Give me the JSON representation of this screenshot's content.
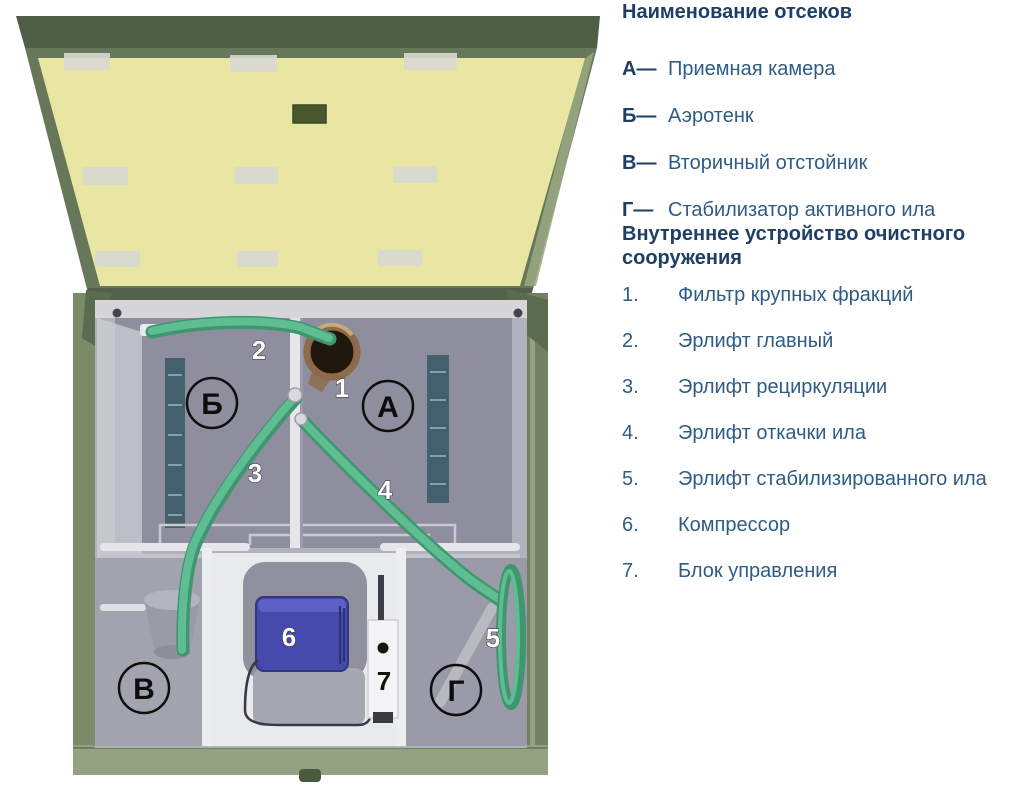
{
  "colors": {
    "lid_frame_green": "#51614a",
    "lid_underside_yellow": "#e9e5a3",
    "shell_green": "#7b8a67",
    "bottom_rim_green": "#93a282",
    "interior_gray": "#8e8e9f",
    "tube_green": "#52ad83",
    "inlet_brown": "#8d6b4a",
    "compressor_blue": "#474aad",
    "heading_text_blue": "#1e3e66",
    "body_text_blue": "#2e5c85"
  },
  "diagram": {
    "compartments": [
      {
        "letter": "Б"
      },
      {
        "letter": "А"
      },
      {
        "letter": "В"
      },
      {
        "letter": "Г"
      }
    ],
    "numbers": [
      "1",
      "2",
      "3",
      "4",
      "5",
      "6",
      "7"
    ]
  },
  "legend": {
    "compartments_heading": "Наименование отсеков",
    "compartments": [
      {
        "letter": "А—",
        "name": "Приемная камера"
      },
      {
        "letter": "Б—",
        "name": "Аэротенк"
      },
      {
        "letter": "В—",
        "name": "Вторичный отстойник"
      },
      {
        "letter": "Г—",
        "name": "Стабилизатор активного ила"
      }
    ],
    "internals_heading": "Внутреннее устройство очистного сооружения",
    "internals": [
      {
        "num": "1.",
        "name": "Фильтр крупных фракций"
      },
      {
        "num": "2.",
        "name": "Эрлифт главный"
      },
      {
        "num": "3.",
        "name": "Эрлифт рециркуляции"
      },
      {
        "num": "4.",
        "name": "Эрлифт откачки ила"
      },
      {
        "num": "5.",
        "name": "Эрлифт стабилизированного ила"
      },
      {
        "num": "6.",
        "name": "Компрессор"
      },
      {
        "num": "7.",
        "name": "Блок управления"
      }
    ]
  }
}
